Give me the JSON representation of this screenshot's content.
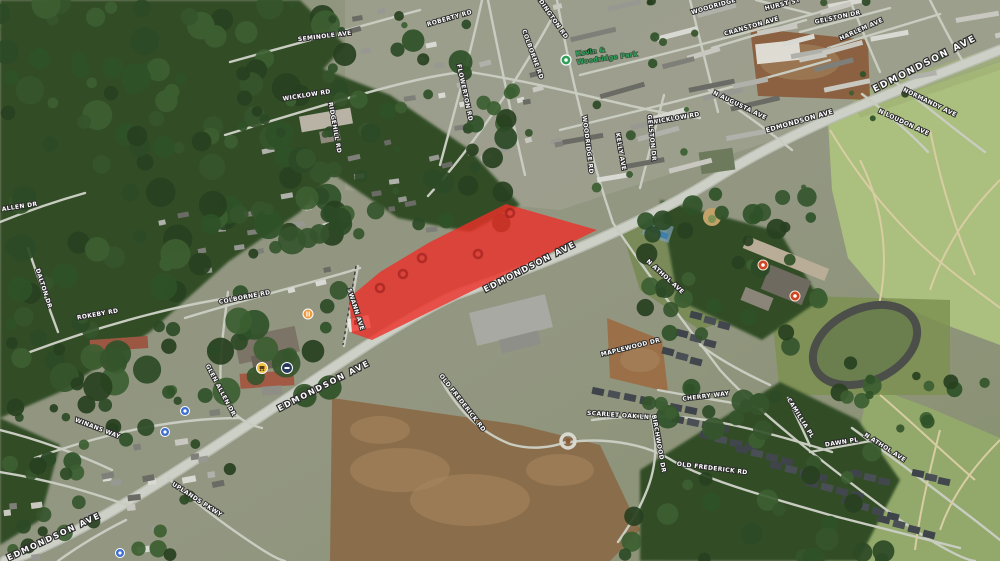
{
  "view": {
    "app": "3d-aerial-satellite-map",
    "description": "Tilted aerial satellite view of the Edmondson Ave corridor with a red highlighted parcel over the shopping-center block",
    "highlight_present": true
  },
  "colors": {
    "highlight_fill": "#ee2f28",
    "highlight_opacity": 0.8,
    "label_fill": "#ffffff",
    "label_outline": "#2b2b2b",
    "park_label_color": "#2fa05a",
    "road": "#c9ccc1",
    "main_road": "#cdd0c6",
    "forest": "#314d27",
    "cemetery": "#abbf7e",
    "park_grass": "#93a96b",
    "dirt_field": "#8a6a48",
    "dimmed_marker_ring": "#8c1212"
  },
  "park_poi": {
    "line1": "Kevin &",
    "line2": "Woodridge Park",
    "x": 576,
    "y": 56,
    "rot": -8
  },
  "street_labels": [
    {
      "t": "SEMINOLE AVE",
      "x": 325,
      "y": 38,
      "r": -7,
      "s": 6
    },
    {
      "t": "ROBERTY RD",
      "x": 450,
      "y": 20,
      "r": -16,
      "s": 6
    },
    {
      "t": "ADDINGTON RD",
      "x": 549,
      "y": 16,
      "r": 55,
      "s": 6
    },
    {
      "t": "WICKLOW RD",
      "x": 307,
      "y": 97,
      "r": -9,
      "s": 6
    },
    {
      "t": "WICKLOW RD",
      "x": 676,
      "y": 120,
      "r": -10,
      "s": 6
    },
    {
      "t": "COLBORNE RD",
      "x": 531,
      "y": 55,
      "r": 70,
      "s": 6
    },
    {
      "t": "FLOWERTON RD",
      "x": 463,
      "y": 93,
      "r": 78,
      "s": 6
    },
    {
      "t": "WOODRIDGE RD",
      "x": 586,
      "y": 145,
      "r": 83,
      "s": 6
    },
    {
      "t": "WOODRIDGE",
      "x": 714,
      "y": 8,
      "r": -16,
      "s": 6
    },
    {
      "t": "GELSTON DR",
      "x": 650,
      "y": 138,
      "r": 84,
      "s": 6
    },
    {
      "t": "GELSTON DR",
      "x": 838,
      "y": 19,
      "r": -12,
      "s": 6
    },
    {
      "t": "HARLEM AVE",
      "x": 862,
      "y": 31,
      "r": -24,
      "s": 6
    },
    {
      "t": "CRANSTON AVE",
      "x": 752,
      "y": 28,
      "r": -16,
      "s": 6
    },
    {
      "t": "HURST ST",
      "x": 783,
      "y": 6,
      "r": -14,
      "s": 6
    },
    {
      "t": "EDMONDSON AVE",
      "x": 926,
      "y": 66,
      "r": -27,
      "s": 9,
      "big": true
    },
    {
      "t": "EDMONDSON AVE",
      "x": 800,
      "y": 123,
      "r": -16,
      "s": 6.5
    },
    {
      "t": "N LOUDON AVE",
      "x": 903,
      "y": 124,
      "r": 25,
      "s": 6
    },
    {
      "t": "NORMANDY AVE",
      "x": 929,
      "y": 104,
      "r": 26,
      "s": 6
    },
    {
      "t": "N AUGUSTA AVE",
      "x": 739,
      "y": 107,
      "r": 26,
      "s": 6
    },
    {
      "t": "EDMONDSON AVE",
      "x": 531,
      "y": 269,
      "r": -27,
      "s": 8,
      "big": true
    },
    {
      "t": "EDMONDSON AVE",
      "x": 325,
      "y": 388,
      "r": -27,
      "s": 8,
      "big": true
    },
    {
      "t": "EDMONDSON AVE",
      "x": 55,
      "y": 539,
      "r": -25,
      "s": 8,
      "big": true
    },
    {
      "t": "N ATHOL AVE",
      "x": 664,
      "y": 278,
      "r": 42,
      "s": 6
    },
    {
      "t": "MAPLEWOOD DR",
      "x": 631,
      "y": 349,
      "r": -14,
      "s": 6
    },
    {
      "t": "CHERRY WAY",
      "x": 706,
      "y": 398,
      "r": -7,
      "s": 6
    },
    {
      "t": "SCARLET OAK LN",
      "x": 618,
      "y": 417,
      "r": 4,
      "s": 6
    },
    {
      "t": "BIRCHWOOD DR",
      "x": 657,
      "y": 444,
      "r": 80,
      "s": 6
    },
    {
      "t": "OLD FREDERICK RD",
      "x": 461,
      "y": 404,
      "r": 52,
      "s": 6
    },
    {
      "t": "OLD FREDERICK RD",
      "x": 712,
      "y": 470,
      "r": 7,
      "s": 6
    },
    {
      "t": "CAMILLIA PL",
      "x": 799,
      "y": 419,
      "r": 58,
      "s": 6
    },
    {
      "t": "DAWN PL",
      "x": 842,
      "y": 444,
      "r": -9,
      "s": 6
    },
    {
      "t": "N ATHOL AVE",
      "x": 884,
      "y": 449,
      "r": 33,
      "s": 6
    },
    {
      "t": "SWANN AVE",
      "x": 354,
      "y": 310,
      "r": 72,
      "s": 6
    },
    {
      "t": "GLEN ALLEN DR",
      "x": 219,
      "y": 391,
      "r": 62,
      "s": 6
    },
    {
      "t": "WINANS WAY",
      "x": 97,
      "y": 430,
      "r": 21,
      "s": 6
    },
    {
      "t": "UPLANDS PKWY",
      "x": 196,
      "y": 501,
      "r": 33,
      "s": 6
    },
    {
      "t": "ROKEBY RD",
      "x": 98,
      "y": 316,
      "r": -10,
      "s": 6
    },
    {
      "t": "DALTON DR",
      "x": 42,
      "y": 289,
      "r": 72,
      "s": 6
    },
    {
      "t": "N ALLEN DR",
      "x": 16,
      "y": 209,
      "r": -9,
      "s": 6
    },
    {
      "t": "COLBORNE RD",
      "x": 245,
      "y": 299,
      "r": -11,
      "s": 6
    },
    {
      "t": "RIDGEHILL RD",
      "x": 333,
      "y": 128,
      "r": 80,
      "s": 6
    },
    {
      "t": "KELLY AVE",
      "x": 619,
      "y": 152,
      "r": 80,
      "s": 6
    }
  ],
  "poi_icons": [
    {
      "name": "park-ring-icon",
      "x": 566,
      "y": 60,
      "c": "#2fa05a"
    },
    {
      "name": "restaurant-icon",
      "x": 308,
      "y": 314,
      "c": "#ef9a3c"
    },
    {
      "name": "grocery-cart-icon",
      "x": 262,
      "y": 368,
      "c": "#eec13f"
    },
    {
      "name": "transit-icon",
      "x": 287,
      "y": 368,
      "c": "#27395c"
    },
    {
      "name": "blue-poi-icon",
      "x": 185,
      "y": 411,
      "c": "#3f6fd1"
    },
    {
      "name": "blue-poi-icon",
      "x": 165,
      "y": 432,
      "c": "#3f6fd1"
    },
    {
      "name": "blue-poi-icon",
      "x": 120,
      "y": 553,
      "c": "#3f6fd1"
    },
    {
      "name": "school-marker-icon",
      "x": 763,
      "y": 265,
      "c": "#cf4722"
    },
    {
      "name": "school-marker-icon",
      "x": 795,
      "y": 296,
      "c": "#cf4722"
    }
  ],
  "highlight_polygon": "506,204 597,230 372,340 352,333 349,298 380,272 430,242",
  "dimmed_markers": [
    [
      510,
      213
    ],
    [
      478,
      254
    ],
    [
      422,
      258
    ],
    [
      403,
      274
    ],
    [
      380,
      288
    ]
  ]
}
